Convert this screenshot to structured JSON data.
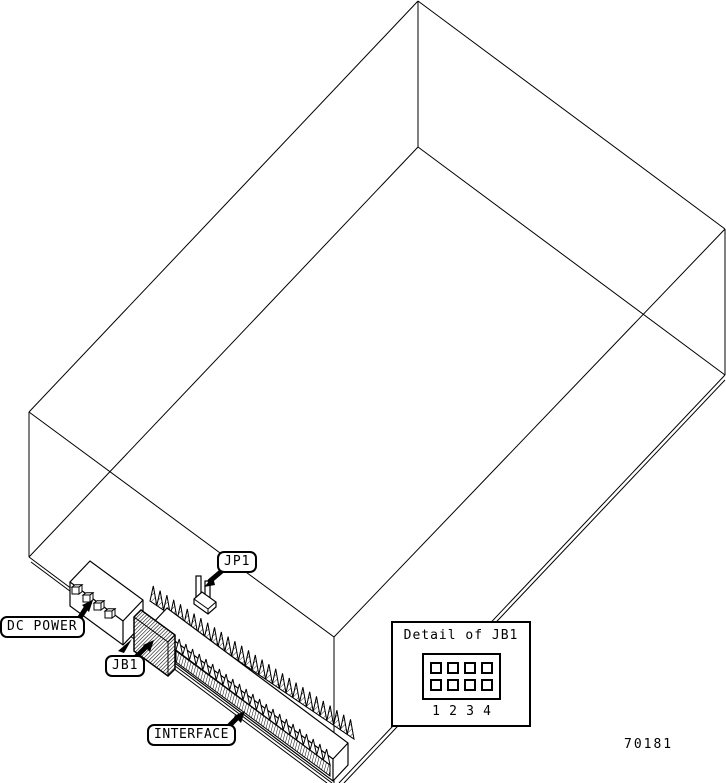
{
  "diagram": {
    "callouts": {
      "jp1": "JP1",
      "dc_power": "DC POWER",
      "jb1": "JB1",
      "interface": "INTERFACE"
    },
    "detail_box": {
      "title": "Detail of JB1",
      "pin_numbers": [
        "1",
        "2",
        "3",
        "4"
      ]
    },
    "part_number": "70181",
    "colors": {
      "line": "#000000",
      "background": "#ffffff"
    }
  }
}
